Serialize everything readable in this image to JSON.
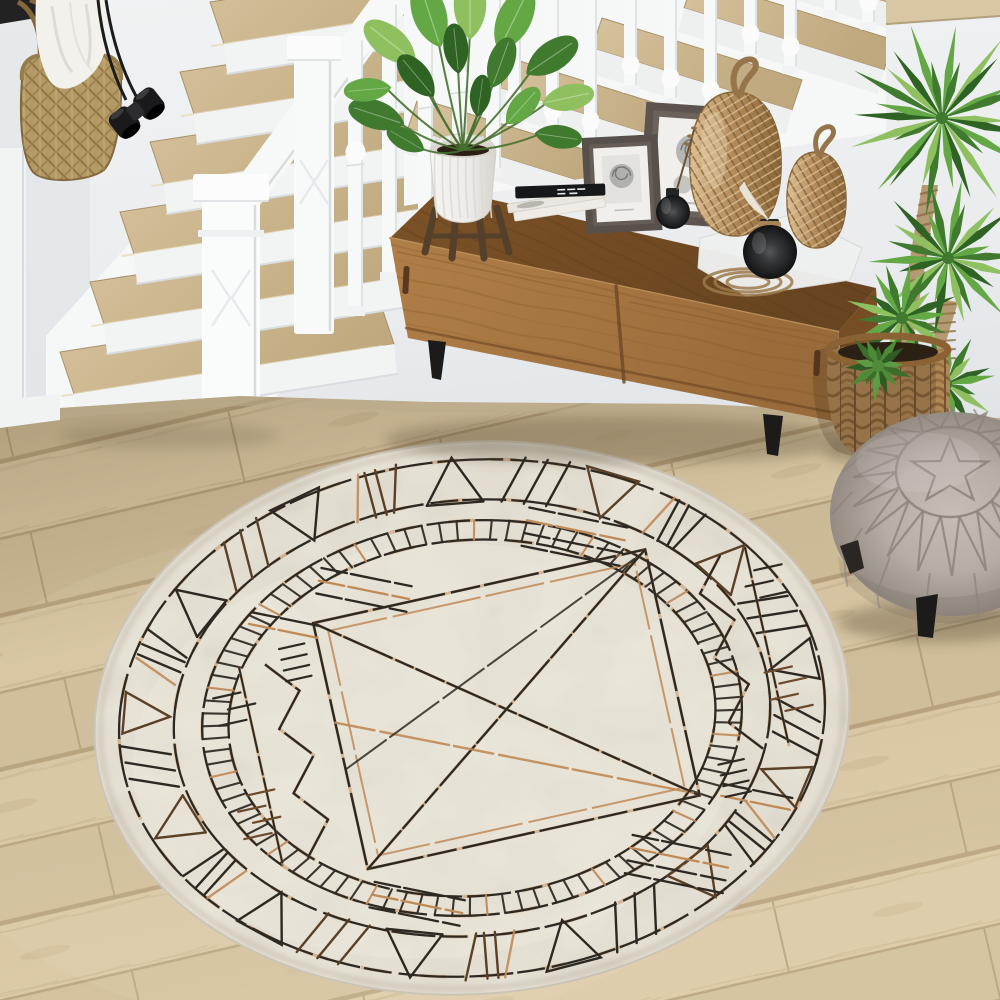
{
  "scene": {
    "title": "Bright entryway with white staircase, wooden sideboard, plants, gray pouf and oval geometric rug",
    "colors": {
      "wall": "#eaecee",
      "wall_dark": "#dde1e4",
      "white_trim": "#f6f7f7",
      "trim_shade": "#d8dcde",
      "tread_light": "#d6c29c",
      "tread_dark": "#bfa87e",
      "tread_edge": "#a8916a",
      "floor_light": "#dbc8a5",
      "floor_base": "#d2bf9b",
      "floor_seam": "#b7a07b",
      "floor_grain": "#c7b28c",
      "sideboard_front": "#b07e48",
      "sideboard_front_dark": "#996b3a",
      "sideboard_top": "#7d5227",
      "sideboard_top_dark": "#684420",
      "sideboard_side": "#774e24",
      "grain": "#7c5228",
      "leg_black": "#1d1b19",
      "rug_base": "#e7e2d6",
      "rug_mottle": "#b4ada0",
      "rug_light": "#f2eee4",
      "rug_dark": "#2d2822",
      "rug_copper": "#c08a57",
      "rug_copper_light": "#dca56e",
      "wicker": "#b08857",
      "wicker_dark": "#7c5a33",
      "wicker_light": "#dcbf93",
      "bag": "#b49a64",
      "bag_dark": "#83683c",
      "green1": "#63a844",
      "green2": "#3f7a2e",
      "green3": "#8fc060",
      "green4": "#2f6323",
      "trunk": "#b49a72",
      "trunk_ring": "#8a6f47",
      "pot_white": "#edebe7",
      "pot_shade": "#d7d4ce",
      "stand_wood": "#55402c",
      "pouf": "#b7aea6",
      "pouf_dark": "#9a9189",
      "pouf_seam": "#8d847c",
      "frame_dark": "#57504b",
      "mat_white": "#f0efeb",
      "print_gray": "#a7a7a5",
      "vase_dark": "#232526",
      "vase_light": "#54585a",
      "cloth": "#f3f1ec",
      "cloth_shade": "#d9d5cc",
      "soil": "#2a2014",
      "binocular": "#1a1a1c",
      "strap": "#1c1c1c",
      "board_tan": "#d8c6a4",
      "shadow": "#4a3c28"
    },
    "objects": [
      {
        "id": "staircase",
        "label": "White staircase with oak treads and turned balusters"
      },
      {
        "id": "hanging-bag",
        "label": "Woven straw tote bag hanging with white cloth"
      },
      {
        "id": "binoculars",
        "label": "Black binoculars on straps"
      },
      {
        "id": "sideboard",
        "label": "Mid-century wooden sideboard with sliding doors"
      },
      {
        "id": "potted-plant",
        "label": "Green houseplant in ribbed white pot on wooden stand"
      },
      {
        "id": "books",
        "label": "Stack of books"
      },
      {
        "id": "picture-frames",
        "label": "Two dark leaning picture frames with botanical prints"
      },
      {
        "id": "wicker-ornaments",
        "label": "Two woven rattan gourd ornaments"
      },
      {
        "id": "glass-vases",
        "label": "Dark glass ball vases with feather and twig"
      },
      {
        "id": "yucca-plant",
        "label": "Yucca plants in woven basket"
      },
      {
        "id": "pouf",
        "label": "Greige Moroccan pouf with star stitching"
      },
      {
        "id": "rug",
        "label": "Oval cream rug with black and copper geometric pattern"
      },
      {
        "id": "wood-floor",
        "label": "Light oak plank floor"
      }
    ]
  },
  "rug_pattern": {
    "center_x": 472,
    "center_y": 718,
    "rx": 378,
    "ry": 276,
    "rotation": -4.5,
    "bands": {
      "outer_line": 0.935,
      "triangle_inner": 0.79,
      "tick_outer": 0.715,
      "tick_inner": 0.645
    },
    "border_motifs": 26,
    "tick_count": 96
  },
  "pouf_pattern": {
    "petals": 18,
    "side_seams": 14,
    "star_points": 5
  }
}
